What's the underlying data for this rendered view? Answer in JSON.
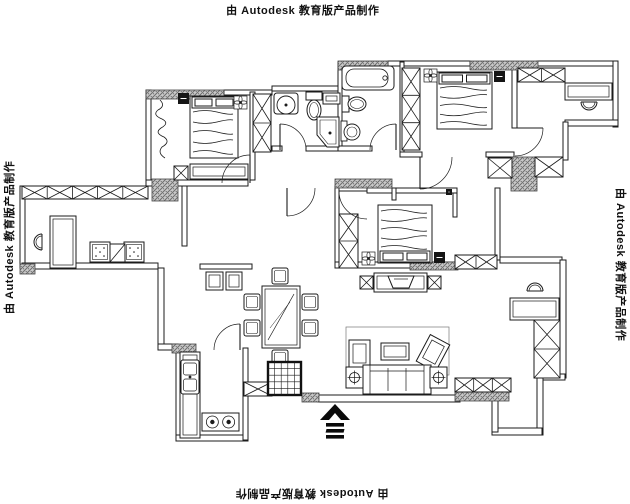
{
  "watermark": {
    "text": "由 Autodesk 教育版产品制作"
  },
  "plan": {
    "stroke": "#1b1b1b",
    "hatch_fill": "#c8c8c8",
    "hatch_line": "#6e6e6e",
    "walls": [
      [
        224,
        90,
        48,
        5
      ],
      [
        272,
        86,
        68,
        5
      ],
      [
        388,
        61,
        82,
        5
      ],
      [
        537,
        61,
        81,
        5
      ],
      [
        146,
        90,
        5,
        95
      ],
      [
        20,
        186,
        5,
        82
      ],
      [
        613,
        61,
        5,
        66
      ],
      [
        565,
        120,
        53,
        6
      ],
      [
        563,
        122,
        5,
        38
      ],
      [
        22,
        263,
        136,
        6
      ],
      [
        158,
        268,
        6,
        80
      ],
      [
        158,
        344,
        20,
        6
      ],
      [
        176,
        348,
        5,
        92
      ],
      [
        176,
        435,
        72,
        6
      ],
      [
        243,
        348,
        5,
        92
      ],
      [
        318,
        395,
        142,
        7
      ],
      [
        500,
        257,
        62,
        6
      ],
      [
        560,
        260,
        6,
        118
      ],
      [
        537,
        374,
        28,
        6
      ],
      [
        537,
        378,
        6,
        57
      ],
      [
        492,
        428,
        50,
        7
      ],
      [
        492,
        400,
        6,
        32
      ],
      [
        250,
        92,
        5,
        88
      ],
      [
        338,
        62,
        4,
        88
      ],
      [
        400,
        62,
        4,
        95
      ],
      [
        512,
        68,
        5,
        60
      ],
      [
        272,
        146,
        10,
        5
      ],
      [
        306,
        146,
        34,
        5
      ],
      [
        338,
        146,
        34,
        5
      ],
      [
        400,
        152,
        22,
        5
      ],
      [
        486,
        152,
        28,
        5
      ],
      [
        453,
        190,
        4,
        27
      ],
      [
        367,
        188,
        90,
        5
      ],
      [
        495,
        188,
        5,
        72
      ],
      [
        335,
        186,
        4,
        82
      ],
      [
        335,
        262,
        127,
        6
      ],
      [
        146,
        180,
        102,
        6
      ],
      [
        182,
        186,
        5,
        60
      ],
      [
        200,
        264,
        52,
        5
      ],
      [
        392,
        188,
        4,
        12
      ]
    ],
    "hatches": [
      [
        146,
        90,
        78,
        9
      ],
      [
        152,
        179,
        26,
        22
      ],
      [
        335,
        179,
        57,
        9
      ],
      [
        338,
        61,
        50,
        9
      ],
      [
        470,
        61,
        68,
        9
      ],
      [
        511,
        157,
        26,
        34
      ],
      [
        455,
        392,
        54,
        9
      ],
      [
        302,
        393,
        17,
        9
      ],
      [
        172,
        344,
        24,
        9
      ],
      [
        20,
        264,
        15,
        10
      ],
      [
        410,
        262,
        48,
        8
      ]
    ],
    "windows": [
      [
        22,
        186,
        126,
        13,
        5
      ],
      [
        518,
        68,
        47,
        14,
        2
      ],
      [
        535,
        157,
        28,
        20,
        1
      ],
      [
        455,
        255,
        42,
        14,
        2
      ],
      [
        244,
        382,
        28,
        14,
        1
      ],
      [
        455,
        378,
        56,
        14,
        3
      ],
      [
        488,
        158,
        24,
        20,
        1
      ]
    ],
    "wardrobes": [
      [
        253,
        94,
        18,
        58,
        2
      ],
      [
        402,
        68,
        18,
        82,
        3
      ],
      [
        339,
        214,
        19,
        54,
        2
      ],
      [
        534,
        320,
        26,
        58,
        2
      ]
    ],
    "doors": [
      {
        "hx": 250,
        "hy": 183,
        "tx": 250,
        "ty": 155,
        "ex": 222,
        "ey": 183,
        "sweep": 0
      },
      {
        "hx": 280,
        "hy": 150,
        "tx": 280,
        "ty": 124,
        "ex": 306,
        "ey": 150,
        "sweep": 1
      },
      {
        "hx": 396,
        "hy": 150,
        "tx": 396,
        "ty": 124,
        "ex": 370,
        "ey": 150,
        "sweep": 0
      },
      {
        "hx": 420,
        "hy": 157,
        "tx": 420,
        "ty": 189,
        "ex": 452,
        "ey": 157,
        "sweep": 0
      },
      {
        "hx": 367,
        "hy": 191,
        "tx": 339,
        "ty": 191,
        "ex": 367,
        "ey": 219,
        "sweep": 0
      },
      {
        "hx": 240,
        "hy": 350,
        "tx": 240,
        "ty": 324,
        "ex": 214,
        "ey": 350,
        "sweep": 0
      },
      {
        "hx": 287,
        "hy": 188,
        "tx": 287,
        "ty": 216,
        "ex": 315,
        "ey": 188,
        "sweep": 0
      },
      {
        "hx": 515,
        "hy": 128,
        "tx": 543,
        "ty": 128,
        "ex": 515,
        "ey": 156,
        "sweep": 1
      }
    ],
    "beds": [
      {
        "x": 190,
        "y": 96,
        "w": 48,
        "h": 62,
        "head": "top"
      },
      {
        "x": 437,
        "y": 72,
        "w": 55,
        "h": 57,
        "head": "top"
      },
      {
        "x": 378,
        "y": 205,
        "w": 54,
        "h": 58,
        "head": "bottom"
      }
    ],
    "flowers": [
      [
        234,
        96,
        13
      ],
      [
        424,
        69,
        13
      ],
      [
        362,
        252,
        13
      ]
    ],
    "darkboxes": [
      [
        178,
        93,
        11
      ],
      [
        494,
        71,
        11
      ],
      [
        434,
        252,
        11
      ],
      [
        446,
        189,
        6
      ]
    ],
    "xboxes": [
      [
        174,
        166,
        14
      ],
      [
        360,
        276,
        13
      ],
      [
        428,
        276,
        13
      ]
    ],
    "cabinets": [
      {
        "x": 190,
        "y": 164,
        "w": 58,
        "h": 15
      },
      {
        "x": 374,
        "y": 273,
        "w": 53,
        "h": 19
      },
      {
        "x": 50,
        "y": 216,
        "w": 26,
        "h": 52
      },
      {
        "x": 565,
        "y": 83,
        "w": 47,
        "h": 17
      },
      {
        "x": 510,
        "y": 298,
        "w": 49,
        "h": 22
      },
      {
        "x": 381,
        "y": 343,
        "w": 28,
        "h": 17
      },
      {
        "x": 180,
        "y": 352,
        "w": 20,
        "h": 86
      },
      {
        "x": 206,
        "y": 272,
        "w": 17,
        "h": 18
      },
      {
        "x": 226,
        "y": 272,
        "w": 16,
        "h": 18
      },
      {
        "x": 323,
        "y": 93,
        "w": 17,
        "h": 11
      }
    ],
    "tv": {
      "x": 388,
      "y": 276,
      "w": 26,
      "h": 12
    },
    "chairs_u": [
      {
        "x": 42,
        "y": 242,
        "rot": 90
      },
      {
        "x": 589,
        "y": 102,
        "rot": 0
      },
      {
        "x": 535,
        "y": 291,
        "rot": 180
      }
    ],
    "cube_chairs": [
      [
        90,
        242,
        20
      ],
      [
        124,
        242,
        20
      ]
    ],
    "diag_boxes": [
      [
        110,
        244,
        15,
        18
      ]
    ],
    "dining": {
      "table": {
        "x": 262,
        "y": 286,
        "w": 38,
        "h": 62
      },
      "chair_size": 16,
      "chairs": [
        [
          244,
          294
        ],
        [
          244,
          320
        ],
        [
          302,
          294
        ],
        [
          302,
          320
        ],
        [
          272,
          268
        ],
        [
          272,
          350
        ]
      ]
    },
    "sofa": {
      "rug": [
        346,
        327,
        103,
        48
      ],
      "armchair_left": [
        349,
        340,
        21,
        29
      ],
      "armchair_right": {
        "x": 422,
        "y": 338,
        "w": 22,
        "h": 30,
        "rot": 28
      },
      "couch": [
        363,
        365,
        68,
        29
      ],
      "side_tables": [
        [
          346,
          367,
          17,
          21
        ],
        [
          430,
          367,
          17,
          21
        ]
      ]
    },
    "fixtures": {
      "sink1": {
        "box": [
          274,
          93,
          24,
          21
        ],
        "cx": 286,
        "cy": 105,
        "r": 9
      },
      "sink2": {
        "box": [
          341,
          121,
          6,
          20
        ],
        "cx": 352,
        "cy": 132,
        "r": 8
      },
      "toilet1": {
        "tank": [
          306,
          92,
          16,
          8
        ],
        "cx": 314,
        "cy": 110,
        "rx": 7,
        "ry": 10
      },
      "toilet2": {
        "tank": [
          342,
          96,
          7,
          16
        ],
        "cx": 357,
        "cy": 104,
        "rx": 9,
        "ry": 7
      },
      "shower": {
        "pts": "317,117 339,117 339,147 327,147 317,135",
        "inner": "320,120 336,120 336,144 328,144 320,134",
        "dot": [
          330,
          133
        ]
      },
      "tub": {
        "x": 342,
        "y": 66,
        "w": 52,
        "h": 24
      },
      "ksink": {
        "x": 181,
        "y": 360,
        "w": 18,
        "h": 34
      },
      "stove": {
        "x": 202,
        "y": 413,
        "w": 37,
        "h": 18
      },
      "gridbox": {
        "x": 268,
        "y": 362,
        "w": 33,
        "h": 33
      }
    },
    "curtain": {
      "x": 156,
      "y": 100,
      "h": 58
    },
    "north": {
      "cx": 335,
      "y": 404
    }
  }
}
